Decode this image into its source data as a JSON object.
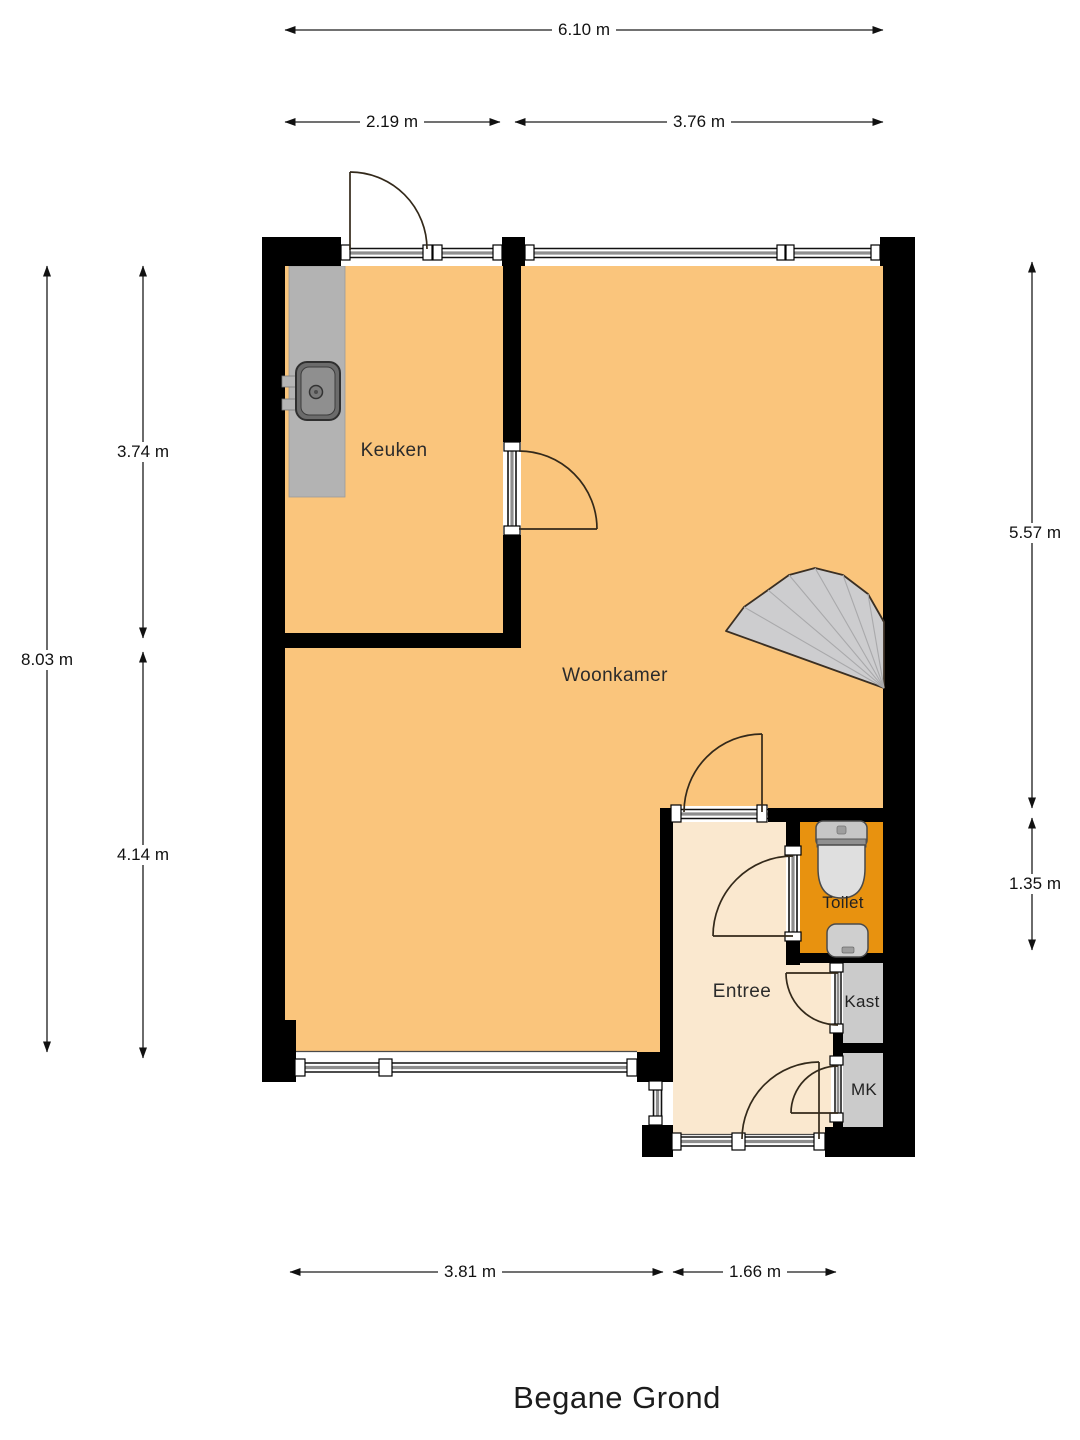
{
  "title": "Begane Grond",
  "rooms": {
    "keuken": "Keuken",
    "woonkamer": "Woonkamer",
    "toilet": "Toilet",
    "entree": "Entree",
    "kast": "Kast",
    "mk": "MK"
  },
  "dimensions": {
    "top_total": "6.10 m",
    "top_keuken": "2.19 m",
    "top_woonkamer": "3.76 m",
    "left_total": "8.03 m",
    "left_upper": "3.74 m",
    "left_lower": "4.14 m",
    "right_upper": "5.57 m",
    "right_lower": "1.35 m",
    "bottom_left": "3.81 m",
    "bottom_right": "1.66 m"
  },
  "icons": {
    "stairs": "stairs-fan-icon",
    "kitchen_sink": "kitchen-sink-icon",
    "wc": "toilet-bowl-icon",
    "hand_basin": "hand-basin-icon",
    "doors": "door-swing-icon",
    "windows": "window-band-icon"
  },
  "colors": {
    "wall": "#000000",
    "room_fill": "#FAC57C",
    "entree_fill": "#FAE8CF",
    "toilet_fill": "#E8920F",
    "closet_fill": "#CBCBCB",
    "stairs_fill": "#CDCDCF",
    "counter_fill": "#B3B3B3",
    "door_arc": "#33291A",
    "dimension_line": "#1C1C1C"
  }
}
